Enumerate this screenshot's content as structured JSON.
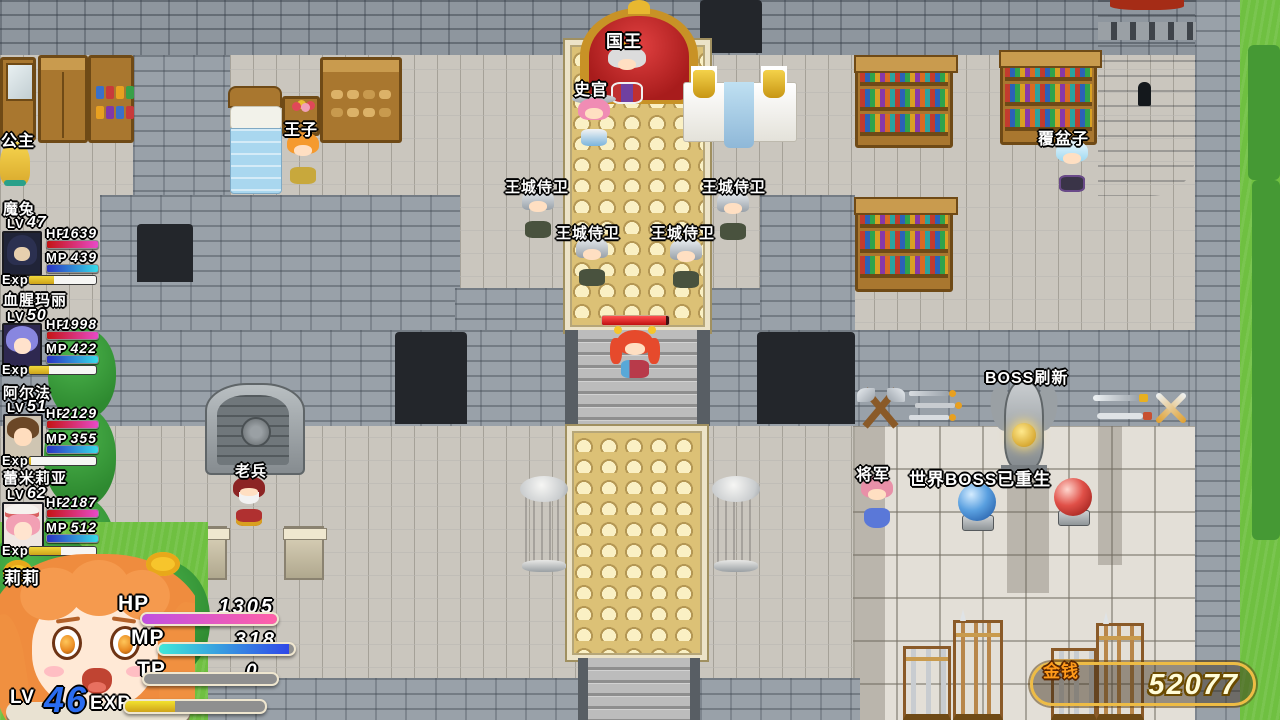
{
  "hud": {
    "stat_labels": {
      "lv": "LV",
      "hp": "HP",
      "mp": "MP",
      "exp": "Exp"
    },
    "party": [
      {
        "name": "魔兔",
        "lv": "47",
        "hp": "1639",
        "mp": "439"
      },
      {
        "name": "血腥玛丽",
        "lv": "50",
        "hp": "1998",
        "mp": "422"
      },
      {
        "name": "阿尔法",
        "lv": "51",
        "hp": "2129",
        "mp": "355"
      },
      {
        "name": "蕾米莉亚",
        "lv": "62",
        "hp": "2187",
        "mp": "512"
      }
    ],
    "player": {
      "name": "莉莉",
      "hp_label": "HP",
      "hp": "1305",
      "mp_label": "MP",
      "mp": "318",
      "tp_label": "TP",
      "tp": "0",
      "lv_label": "LV",
      "lv": "46",
      "exp_label": "EXP"
    },
    "gold": {
      "label": "金钱",
      "amount": "52077"
    }
  },
  "map_labels": {
    "princess": "公主",
    "prince": "王子",
    "king": "国王",
    "historian": "史官",
    "castle_guard": "王城侍卫",
    "raspberry": "覆盆子",
    "old_soldier": "老兵",
    "general": "将军",
    "boss_refresh": "BOSS刷新",
    "world_boss_reborn": "世界BOSS已重生"
  },
  "colors": {
    "hp_gradient_start": "#c41414",
    "hp_gradient_end": "#e84ac8",
    "mp_gradient_start": "#2a32c4",
    "mp_gradient_end": "#36dce8",
    "exp_fill": "#e8c725",
    "main_hp_start": "#c050e0",
    "main_hp_end": "#ff60a8",
    "lv_number": "#2a6cf0",
    "gold_border": "#eebc45",
    "gold_text": "#fffcd8",
    "gold_label": "#ff9a1a"
  }
}
